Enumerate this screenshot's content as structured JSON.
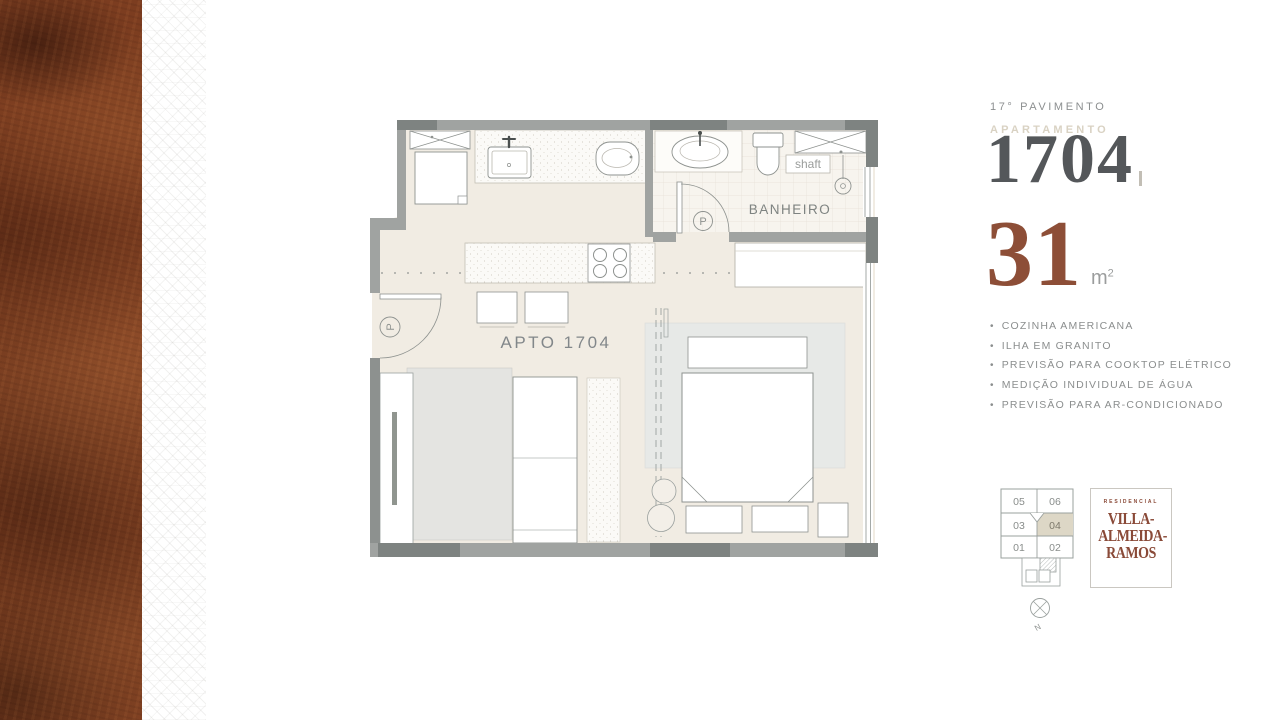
{
  "panel": {
    "floor_label": "17° PAVIMENTO",
    "apartment_label": "APARTAMENTO",
    "apartment_number": "1704",
    "area_value": "31",
    "area_unit": "m",
    "area_exponent": "2",
    "bullet": "•",
    "features": [
      "COZINHA AMERICANA",
      "ILHA EM GRANITO",
      "PREVISÃO PARA COOKTOP ELÉTRICO",
      "MEDIÇÃO INDIVIDUAL DE ÁGUA",
      "PREVISÃO PARA AR-CONDICIONADO"
    ]
  },
  "plan": {
    "unit_label": "APTO  1704",
    "bathroom_label": "BANHEIRO",
    "shaft_label": "shaft",
    "door_marker": "P"
  },
  "keyplan": {
    "units": [
      [
        "05",
        "06"
      ],
      [
        "03",
        "04"
      ],
      [
        "01",
        "02"
      ]
    ],
    "highlighted_unit": "04",
    "compass_label": "N"
  },
  "logo": {
    "brand_prefix": "RESIDENCIAL",
    "brand_lines": [
      "VILLA-",
      "ALMEIDA-",
      "RAMOS"
    ]
  },
  "colors": {
    "accent_brown": "#8d4e37",
    "number_gray": "#54575a",
    "wall_gray": "#a0a3a1",
    "wall_dark_gray": "#7e8381",
    "floor_beige": "#f1ece3",
    "highlight_beige": "#ddd7c6"
  }
}
